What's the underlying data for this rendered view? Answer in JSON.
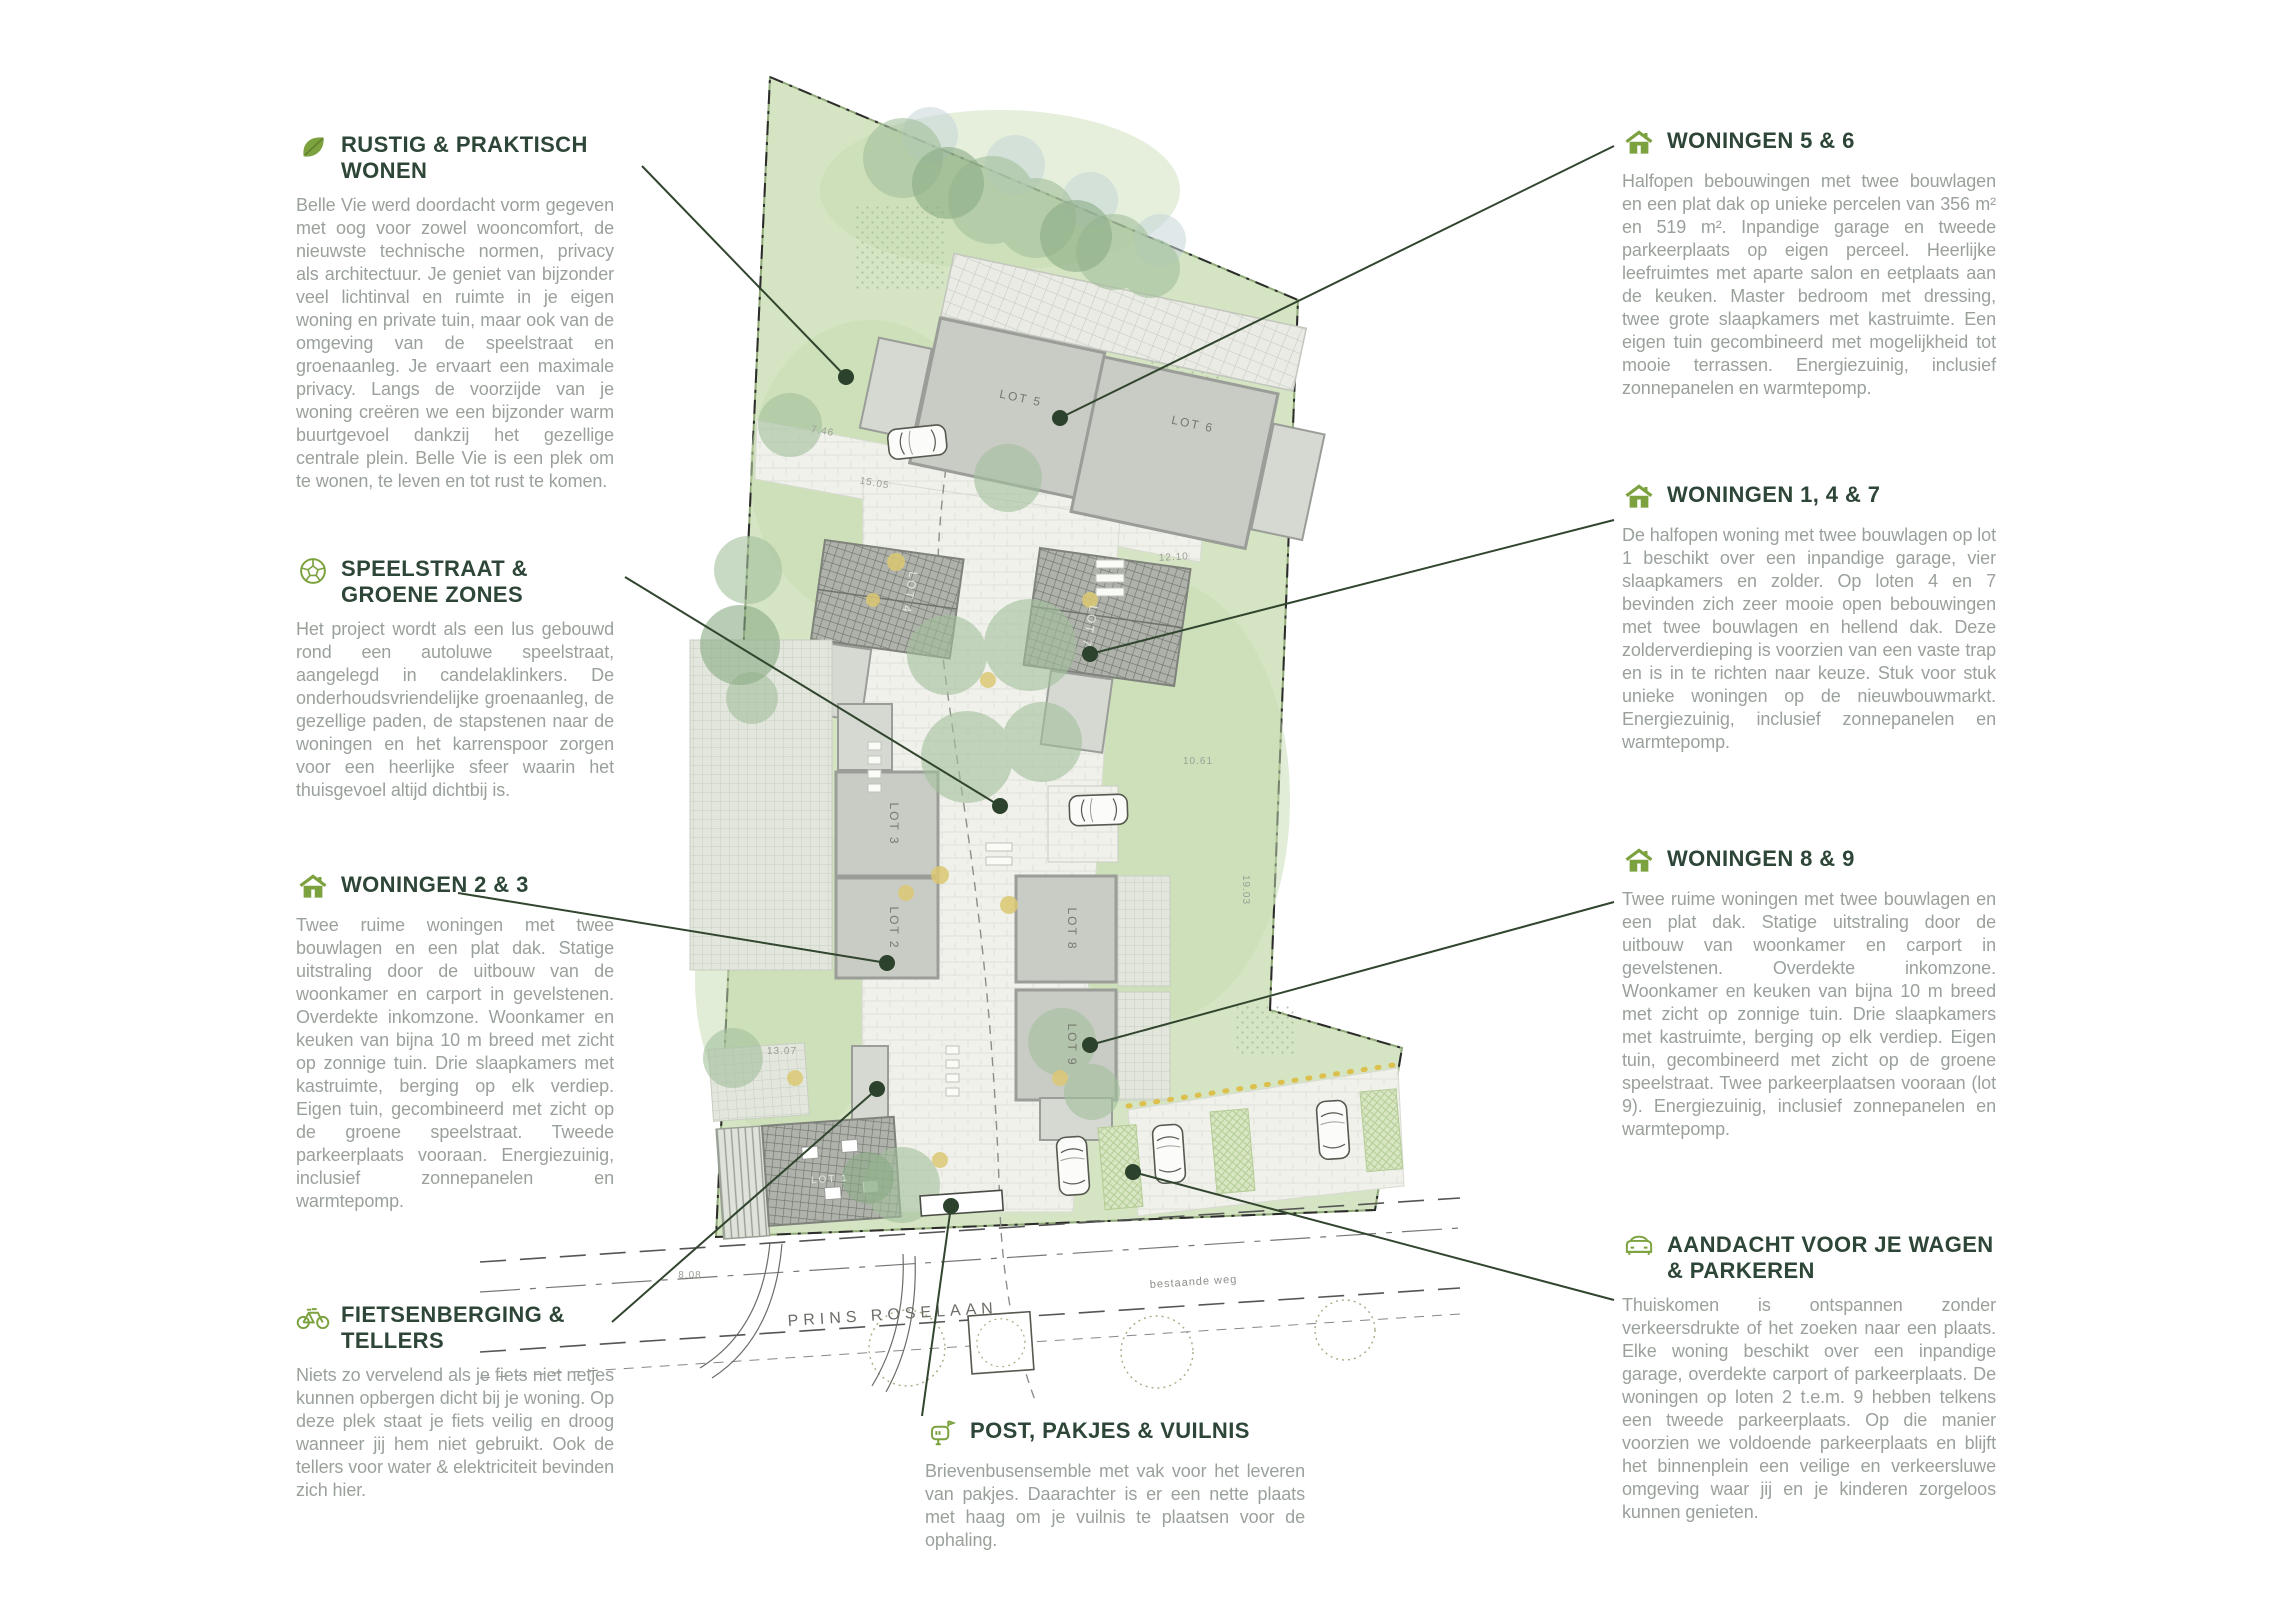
{
  "annotations": {
    "left": [
      {
        "icon": "leaf",
        "title": "RUSTIG & PRAKTISCH WONEN",
        "body": "Belle Vie werd doordacht vorm gegeven met oog voor zowel wooncomfort, de nieuwste technische normen, privacy als architectuur. Je geniet van bijzonder veel lichtinval en ruimte in je eigen woning en private tuin, maar ook van de omgeving van de speelstraat en groenaanleg. Je ervaart een maximale privacy. Langs de voorzijde van je woning creëren we een bijzonder warm buurtgevoel dankzij het gezellige centrale plein. Belle Vie is een plek om te wonen, te leven en tot rust te komen."
      },
      {
        "icon": "ball",
        "title": "SPEELSTRAAT & GROENE ZONES",
        "body": "Het project wordt als een lus gebouwd rond een autoluwe speelstraat, aangelegd in candelaklinkers. De onderhoudsvriendelijke groenaanleg, de gezellige paden, de stapstenen naar de woningen en het karrenspoor zorgen voor een heerlijke sfeer waarin het thuisgevoel altijd dichtbij is."
      },
      {
        "icon": "house",
        "title": "WONINGEN 2 & 3",
        "body": "Twee ruime woningen met twee bouwlagen en een plat dak. Statige uitstraling door de uitbouw van de woonkamer en carport in gevelstenen. Overdekte inkomzone. Woonkamer en keuken van bijna 10 m breed met zicht op zonnige tuin. Drie slaapkamers met kastruimte, berging op elk verdiep. Eigen tuin, gecombineerd met zicht op de groene speelstraat. Tweede parkeerplaats vooraan. Energiezuinig, inclusief zonnepanelen en warmtepomp."
      },
      {
        "icon": "bicycle",
        "title": "FIETSENBERGING & TELLERS",
        "body": "Niets zo vervelend als je fiets niet netjes kunnen opbergen dicht bij je woning. Op deze plek staat je fiets veilig en droog wanneer jij hem niet gebruikt. Ook de tellers voor water & elektriciteit bevinden zich hier."
      }
    ],
    "right": [
      {
        "icon": "house",
        "title": "WONINGEN 5 & 6",
        "body": "Halfopen bebouwingen met twee bouwlagen en een plat dak op unieke percelen van 356 m² en 519 m². Inpandige garage en tweede parkeerplaats op eigen perceel. Heerlijke leefruimtes met aparte salon en eetplaats aan de keuken. Master bedroom met dressing, twee grote slaapkamers met kastruimte. Een eigen tuin gecombineerd met mogelijkheid tot mooie terrassen. Energiezuinig, inclusief zonnepanelen en warmtepomp."
      },
      {
        "icon": "house",
        "title": "WONINGEN 1, 4 & 7",
        "body": "De halfopen woning met twee bouwlagen op lot 1 beschikt over een inpandige garage, vier slaapkamers en zolder. Op loten 4 en 7 bevinden zich zeer mooie open bebouwingen met twee bouwlagen en hellend dak. Deze zolderverdieping is voorzien van een vaste trap en is in te richten naar keuze. Stuk voor stuk unieke woningen op de nieuwbouwmarkt. Energiezuinig, inclusief zonnepanelen en warmtepomp."
      },
      {
        "icon": "house",
        "title": "WONINGEN 8 & 9",
        "body": "Twee ruime woningen met twee bouwlagen en een plat dak. Statige uitstraling door de uitbouw van woonkamer en carport in gevelstenen. Overdekte inkomzone. Woonkamer en keuken van bijna 10 m breed met zicht op zonnige tuin. Drie slaapkamers met kastruimte, berging op elk verdiep. Eigen tuin, gecombineerd met zicht op de groene speelstraat. Twee parkeerplaatsen vooraan (lot 9). Energiezuinig, inclusief zonnepanelen en warmtepomp."
      },
      {
        "icon": "car",
        "title": "AANDACHT VOOR JE WAGEN & PARKEREN",
        "body": "Thuiskomen is ontspannen zonder verkeersdrukte of het zoeken naar een plaats. Elke woning beschikt over een inpandige garage, overdekte carport of parkeerplaats. De woningen op loten 2 t.e.m. 9 hebben telkens een tweede parkeerplaats. Op die manier voorzien we voldoende parkeerplaats en blijft het binnenplein een veilige en verkeersluwe omgeving waar jij en je kinderen zorgeloos kunnen genieten."
      }
    ],
    "bottom": {
      "icon": "mailbox",
      "title": "POST, PAKJES & VUILNIS",
      "body": "Brievenbusensemble met vak voor het leveren van pakjes. Daarachter is er een nette plaats met haag om je vuilnis te plaatsen voor de ophaling."
    }
  },
  "map": {
    "street_primary": "PRINS ROSELAAN",
    "street_secondary": "bestaande weg",
    "lots": [
      "LOT 1",
      "LOT 2",
      "LOT 3",
      "LOT 4",
      "LOT 5",
      "LOT 6",
      "LOT 7",
      "LOT 8",
      "LOT 9"
    ],
    "dimensions": [
      "7.46",
      "15.05",
      "12.10",
      "10.61",
      "19.03",
      "13.07",
      "8.08"
    ]
  },
  "colors": {
    "accent_green": "#7ca23f",
    "heading_green": "#2e4637",
    "body_text": "#9aa19b",
    "site_green": "#d5e4c2",
    "building_gray": "#c9cbc5",
    "connector": "#2c422c"
  }
}
